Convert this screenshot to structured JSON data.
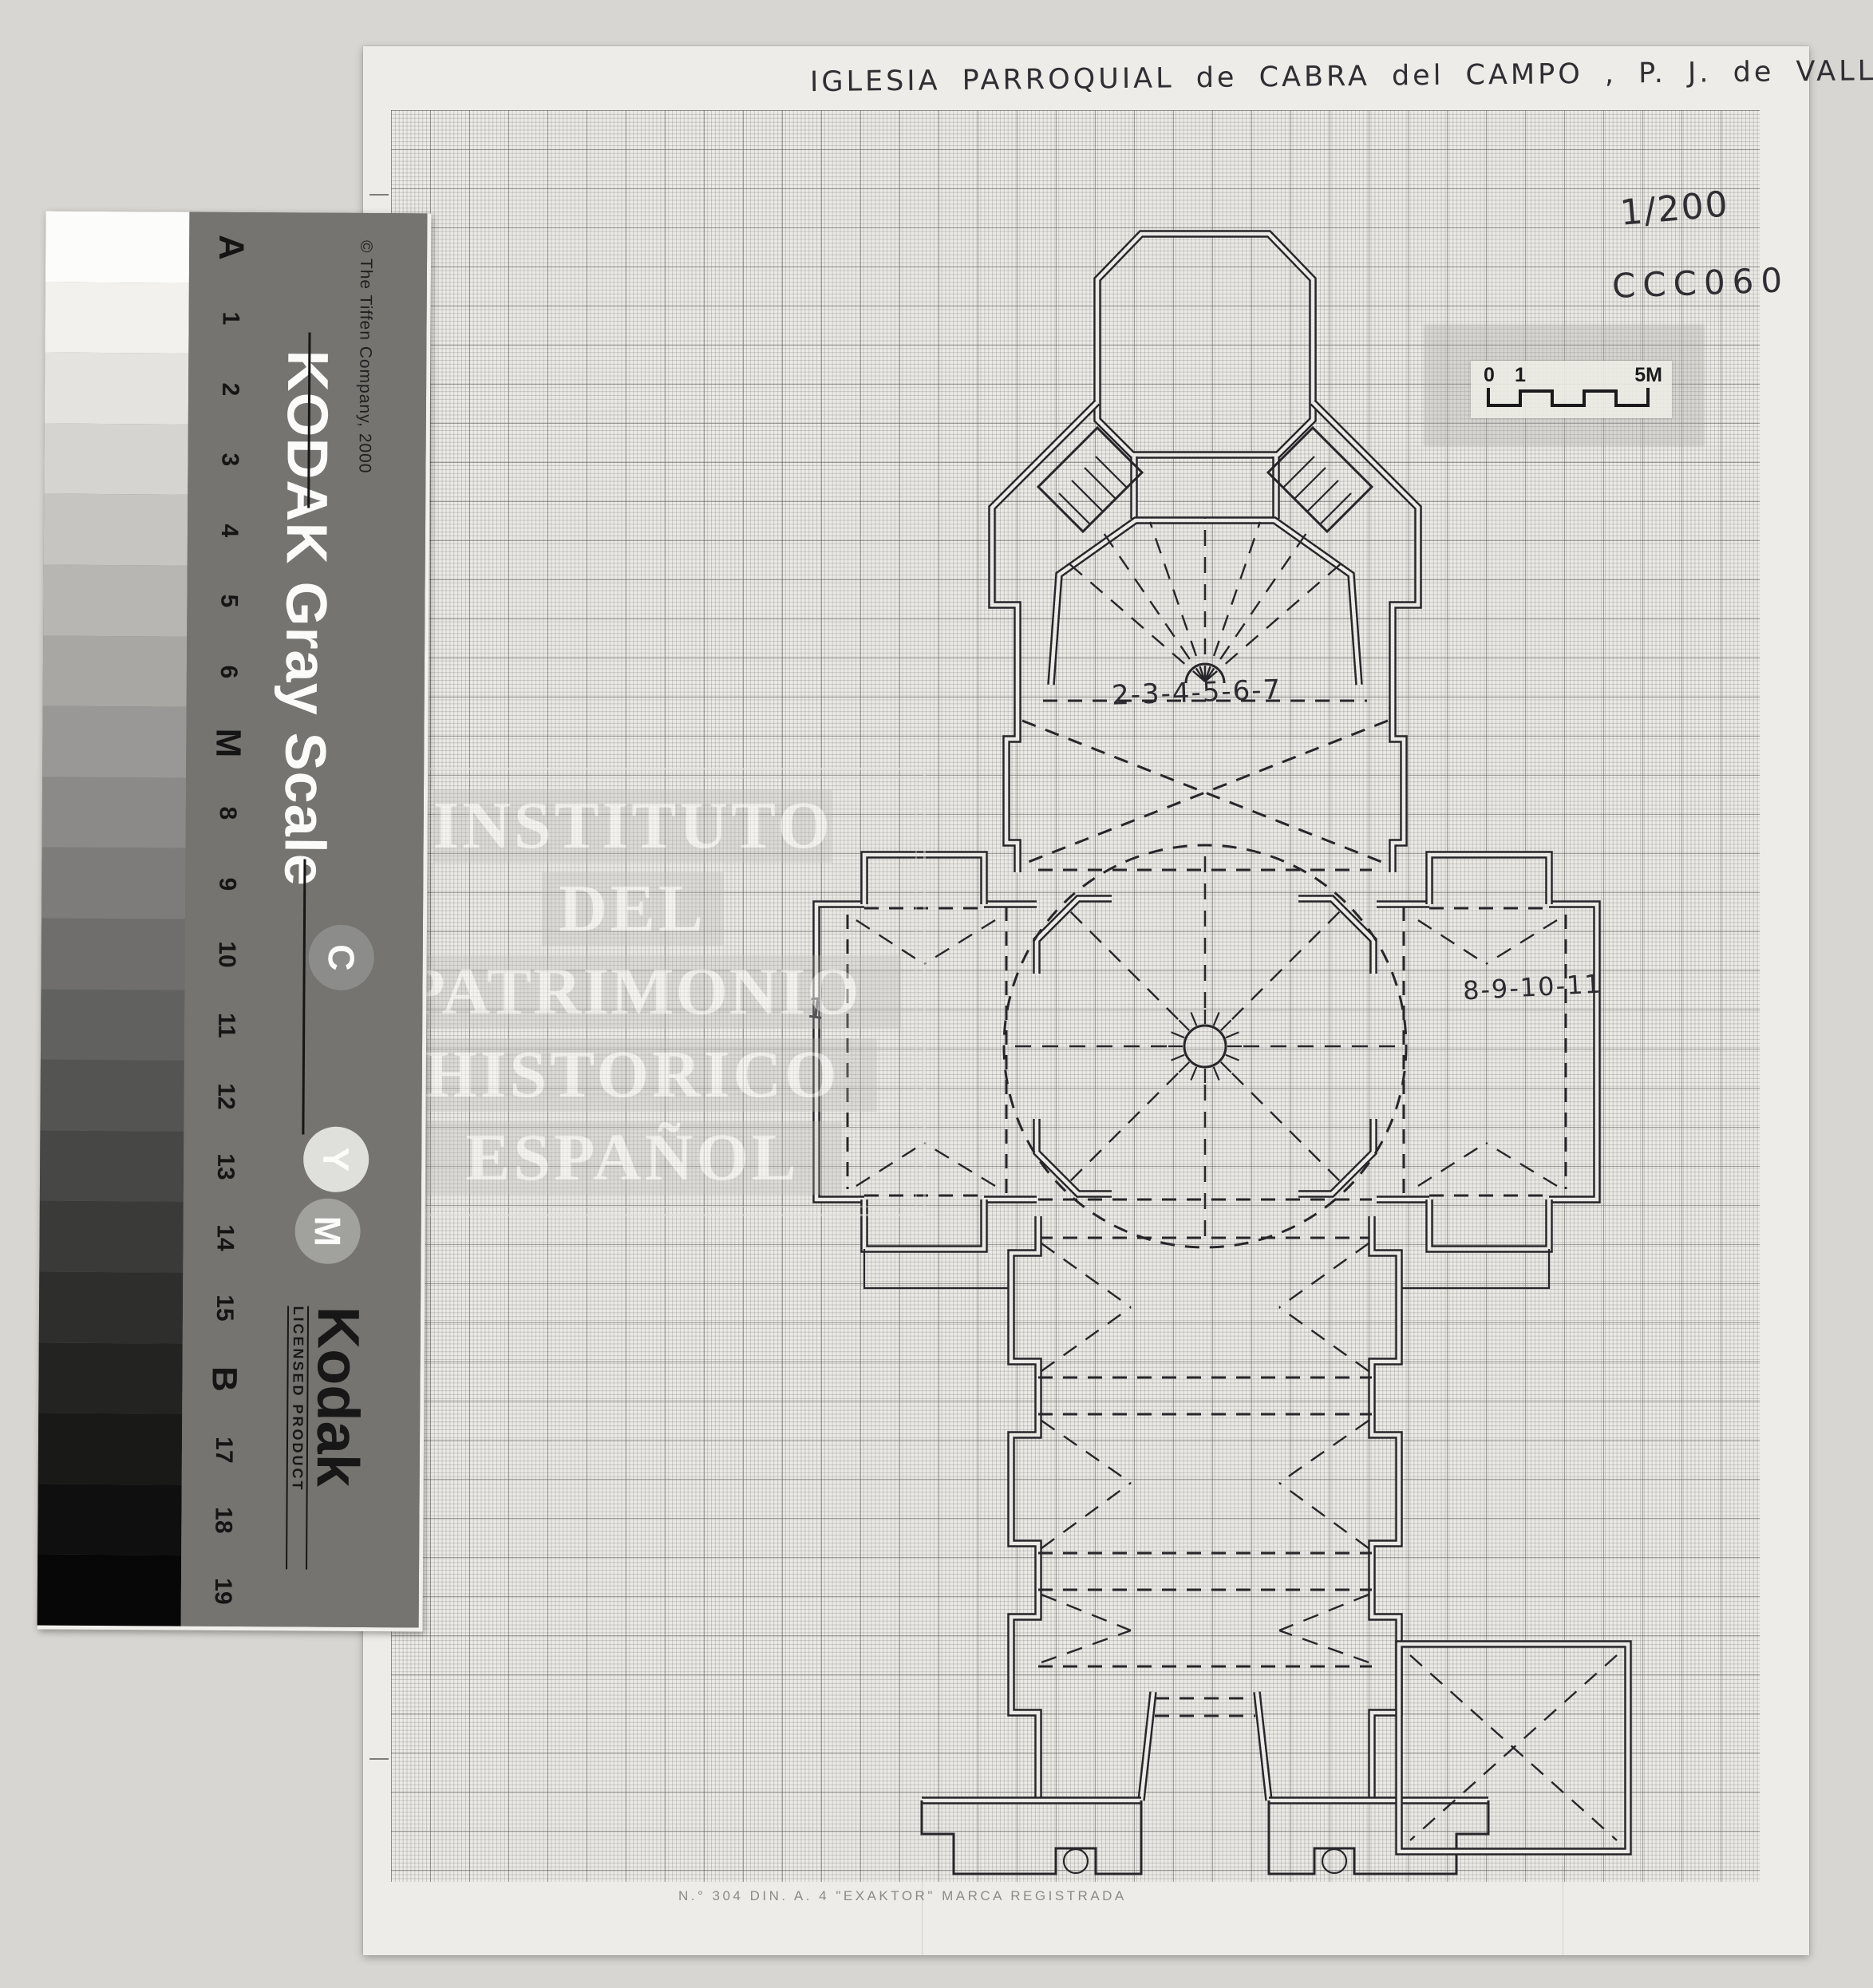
{
  "document": {
    "title_handwritten": "IGLESIA PARROQUIAL de CABRA del CAMPO , P. J. de VALLS",
    "scale_note": "1/200",
    "reference_code": "CCC060",
    "sheet_footer": "N.° 304   DIN. A. 4   \"EXAKTOR\"   MARCA REGISTRADA",
    "scale_bar": {
      "labels": [
        "0",
        "1",
        "5M"
      ]
    },
    "plan_labels": {
      "presbytery": "2-3-4-5-6-7",
      "right_transept": "8-9-10-11",
      "left_transept": "1"
    }
  },
  "watermark": {
    "lines": [
      "INSTITUTO",
      "DEL",
      "PATRIMONIO",
      "HISTORICO",
      "ESPAÑOL"
    ]
  },
  "gray_scale": {
    "copyright": "© The Tiffen Company, 2000",
    "title": "KODAK Gray Scale",
    "brand": "Kodak",
    "brand_sub": "LICENSED PRODUCT",
    "circles": [
      "C",
      "Y",
      "M"
    ],
    "labels": [
      "A",
      "1",
      "2",
      "3",
      "4",
      "5",
      "6",
      "M",
      "8",
      "9",
      "10",
      "11",
      "12",
      "13",
      "14",
      "15",
      "B",
      "17",
      "18",
      "19"
    ],
    "step_colors": [
      "#fcfcfa",
      "#f2f1ee",
      "#e4e3e0",
      "#d5d4d1",
      "#c6c5c2",
      "#b7b6b3",
      "#a8a7a4",
      "#999896",
      "#8b8a88",
      "#7d7c7a",
      "#6f6e6c",
      "#616260",
      "#545452",
      "#474746",
      "#3a3a39",
      "#2e2e2d",
      "#232322",
      "#191918",
      "#100f0f",
      "#070707"
    ]
  },
  "colors": {
    "background": "#d8d6d2",
    "paper": "#eceae6",
    "ink": "#26262a",
    "band": "#757471"
  }
}
